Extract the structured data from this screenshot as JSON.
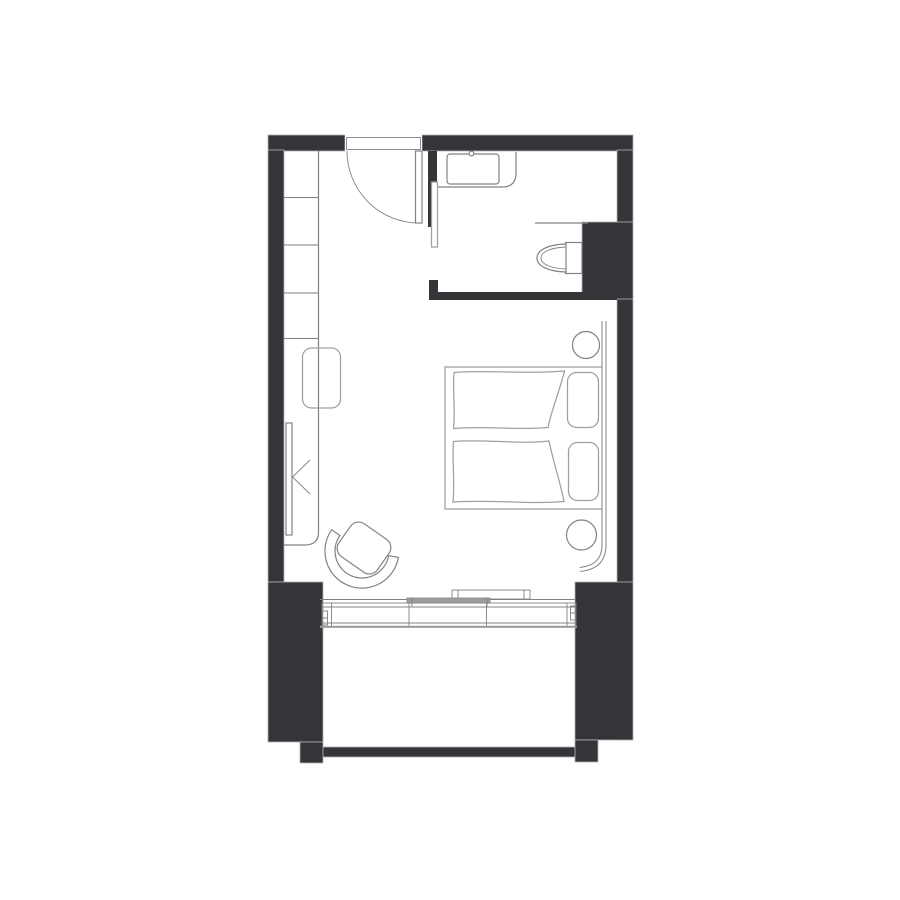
{
  "title": "Hotel studio room floor plan",
  "canvas": {
    "width": 900,
    "height": 900
  },
  "colors": {
    "background": "#ffffff",
    "wall": "#333538",
    "line_dark": "#58595b",
    "line_mid": "#808285",
    "line_soft": "#9d9fa2",
    "line_light": "#b1b3b5",
    "panel": "#9b9da0"
  },
  "floorplan": {
    "type": "architectural-plan",
    "areas": [
      "entry",
      "bathroom",
      "bedroom",
      "balcony"
    ],
    "elements": [
      "entry-swing-door",
      "entry-threshold",
      "wardrobe-shelves",
      "desk-counter",
      "stool",
      "wall-tv",
      "luggage-rack-chevron",
      "bathroom-sliding-door",
      "vanity-counter",
      "sink-basin",
      "faucet",
      "toilet",
      "half-wall-ledge",
      "double-bed-platform",
      "duvet-left",
      "duvet-right",
      "pillow-left",
      "pillow-right",
      "headboard-screen",
      "round-side-table-top",
      "round-side-table-bottom",
      "armchair",
      "curtain-box",
      "curtain-panel",
      "sliding-window-wall",
      "balcony-railing"
    ]
  }
}
